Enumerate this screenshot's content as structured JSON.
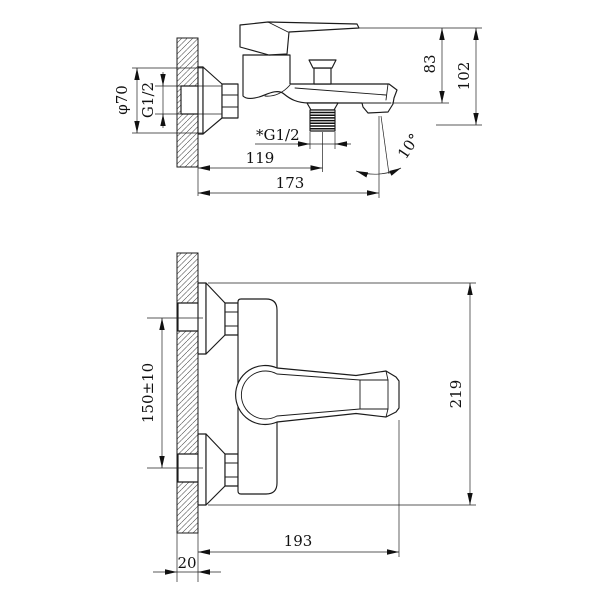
{
  "style": {
    "background": "#ffffff",
    "line_color": "#1b1b1b"
  },
  "top_view": {
    "phi70": "φ70",
    "g12": "G1/2",
    "h83": "83",
    "h102": "102",
    "g12_out": "*G1/2",
    "d119": "119",
    "d173": "173",
    "a10": "10°"
  },
  "plan_view": {
    "d150": "150±10",
    "d219": "219",
    "d193": "193",
    "d20": "20"
  }
}
